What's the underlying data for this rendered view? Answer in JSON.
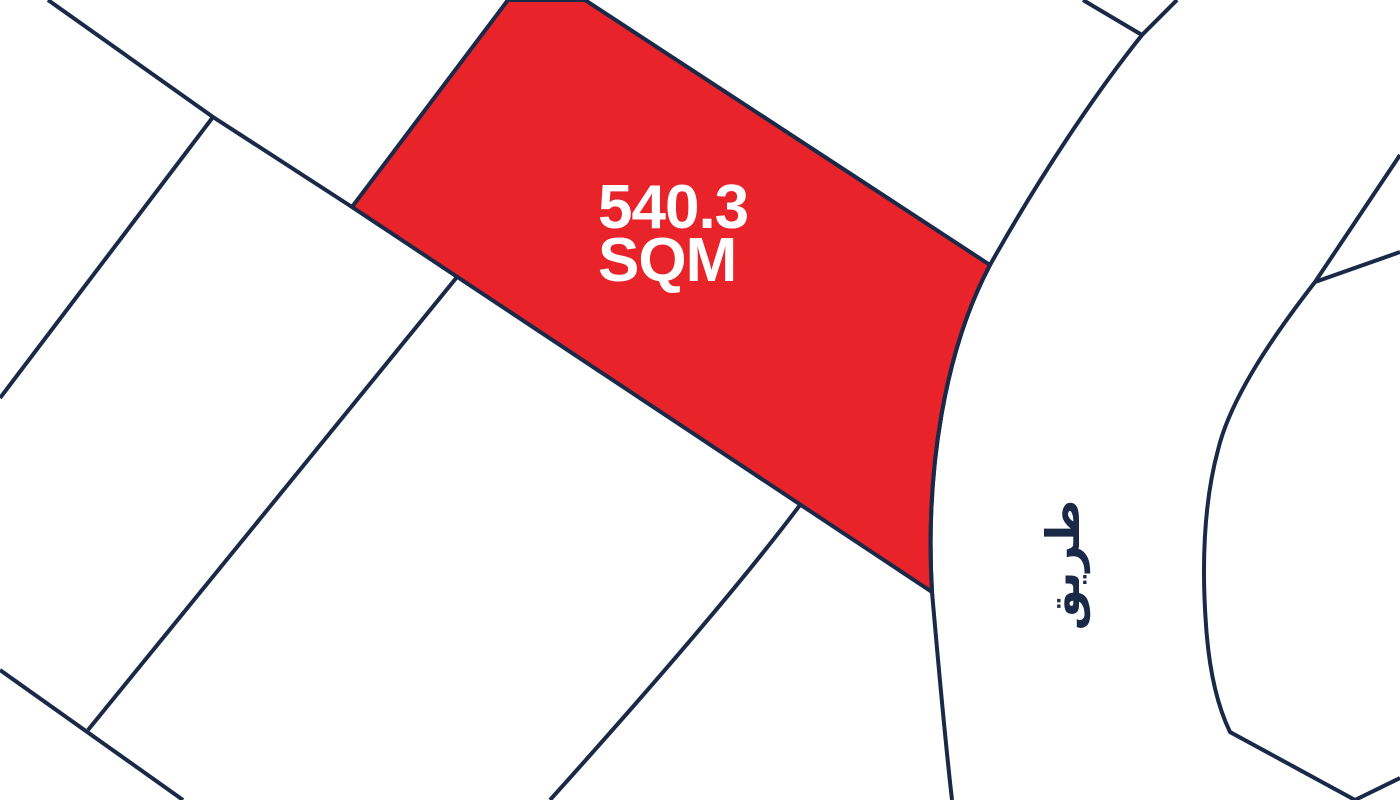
{
  "canvas": {
    "width": 1400,
    "height": 800
  },
  "colors": {
    "background": "#ffffff",
    "boundary": "#1a2947",
    "parcel_fill": "#e8232a",
    "parcel_text": "#ffffff"
  },
  "parcel": {
    "area_value": "540.3",
    "area_unit": "SQM"
  },
  "road": {
    "label": "طريق"
  },
  "paths": {
    "red_parcel": "M 508 0 L 585 0 L 990 265 C 945 350 925 470 932 592 L 352 207 Z",
    "road_left_edge": "M 1177 0 L 1142 35 C 1090 100 1035 185 990 265 C 945 350 925 470 932 592 C 938 660 944 730 952 800",
    "road_right_edge": "M 1400 155 C 1370 200 1340 245 1315 282 C 1270 340 1230 400 1218 450 C 1203 505 1202 570 1206 625 C 1209 670 1217 705 1230 732 L 1355 800",
    "right_side_branch": "M 1315 282 L 1400 252",
    "bottom_right_corner": "M 1400 778 L 1355 800",
    "top_road_branch": "M 1083 0 L 1142 35",
    "upper_left_boundary": "M 48 0 L 213 117 L 352 207",
    "left_down_boundary": "M 213 117 L 0 398",
    "mid_left_branch": "M 457 277 L 88 730",
    "bottom_left_boundary": "M 0 670 L 183 800",
    "lower_mid_branch": "M 800 505 C 740 585 640 700 550 800"
  },
  "label_layout": {
    "parcel_line1_x": "598",
    "parcel_line1_y": "228",
    "parcel_line2_x": "598",
    "parcel_line2_y": "281",
    "road_label_transform": "rotate(-90 1062 565)",
    "road_label_x": "1062",
    "road_label_y": "582"
  }
}
